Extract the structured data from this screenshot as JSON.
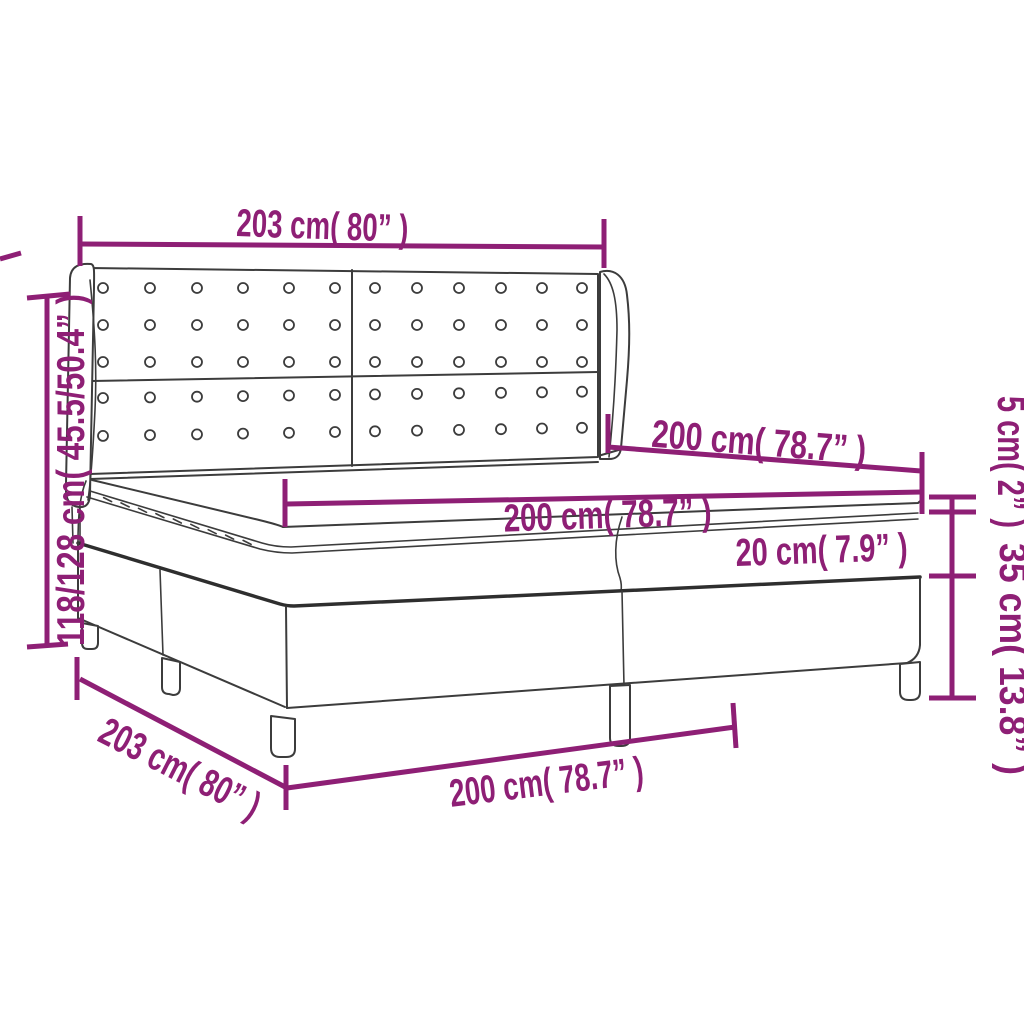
{
  "title": "Box spring bed with tufted wing headboard – dimension diagram",
  "colors": {
    "accent": "#8E1F75",
    "outline": "#3C3C3C",
    "outline_heavy": "#2E2E2E",
    "background": "#FFFFFF"
  },
  "product": {
    "name": "box-spring-bed-with-wing-headboard",
    "parts_shown": [
      "tufted headboard with buttons",
      "left wing",
      "right wing",
      "mattress topper with zipper",
      "mattress",
      "split box spring base",
      "legs"
    ]
  },
  "dimensions": {
    "headboard_width": {
      "label": "203 cm( 80” )",
      "cm": "203",
      "inch": "80",
      "location": "top"
    },
    "overall_height": {
      "label": "118/128 cm( 45.5/50.4” )",
      "cm": "118/128",
      "inch": "45.5/50.4",
      "location": "left"
    },
    "bed_length_upper": {
      "label": "200 cm( 78.7” )",
      "cm": "200",
      "inch": "78.7",
      "location": "upper-diagonal"
    },
    "mattress_length": {
      "label": "200 cm( 78.7” )",
      "cm": "200",
      "inch": "78.7",
      "location": "middle-horizontal"
    },
    "mattress_height": {
      "label": "20 cm( 7.9” )",
      "cm": "20",
      "inch": "7.9",
      "location": "mattress-front-face"
    },
    "topper_height": {
      "label": "5 cm( 2” )",
      "cm": "5",
      "inch": "2",
      "location": "right-upper"
    },
    "base_height": {
      "label": "35 cm( 13.8” )",
      "cm": "35",
      "inch": "13.8",
      "location": "right-lower"
    },
    "bed_depth": {
      "label": "203 cm( 80” )",
      "cm": "203",
      "inch": "80",
      "location": "lower-left-diagonal"
    },
    "base_length": {
      "label": "200 cm( 78.7” )",
      "cm": "200",
      "inch": "78.7",
      "location": "bottom"
    }
  }
}
